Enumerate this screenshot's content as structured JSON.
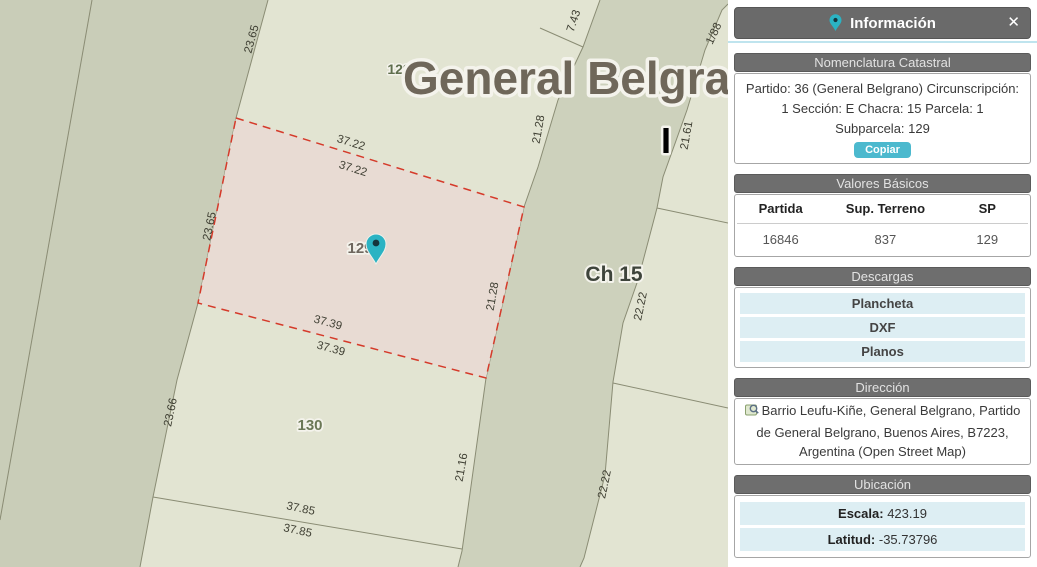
{
  "map": {
    "title": "General Belgrano",
    "labels": {
      "len_2365_a": "23.65",
      "len_2365_b": "23.65",
      "len_3722_a": "37.22",
      "len_3722_b": "37.22",
      "len_3739_a": "37.39",
      "len_3739_b": "37.39",
      "len_2128_a": "21.28",
      "len_2128_b": "21.28",
      "len_743": "7.43",
      "len_188": "1/88",
      "len_2161": "21.61",
      "len_2222_a": "22.22",
      "len_2222_b": "22.22",
      "len_2366": "23.66",
      "len_2116": "21.16",
      "len_3785_a": "37.85",
      "len_3785_b": "37.85",
      "parcel_129": "129",
      "parcel_130": "130",
      "parcel_128": "128",
      "chacra": "Ch 15",
      "roman_i": "I"
    },
    "colors": {
      "parcel_light": "#e2e4d2",
      "parcel_dark": "#c9cdb8",
      "road_strip": "#cdd1bc",
      "highlight_fill": "#e8dbd3",
      "highlight_border": "#d53a2a",
      "pin_teal": "#2bb3c3"
    }
  },
  "panel": {
    "header": {
      "title": "Información",
      "close_icon": "✕"
    },
    "nomenclatura": {
      "section_title": "Nomenclatura Catastral",
      "line1": "Partido: 36 (General Belgrano) Circunscripción:",
      "line2": "1 Sección: E Chacra: 15 Parcela: 1",
      "line3": "Subparcela: 129",
      "copy_button": "Copiar"
    },
    "valores": {
      "section_title": "Valores Básicos",
      "columns": [
        "Partida",
        "Sup. Terreno",
        "SP"
      ],
      "values": [
        "16846",
        "837",
        "129"
      ]
    },
    "descargas": {
      "section_title": "Descargas",
      "items": [
        "Plancheta",
        "DXF",
        "Planos"
      ]
    },
    "direccion": {
      "section_title": "Dirección",
      "text": "Barrio Leufu-Kiñe, General Belgrano, Partido de General Belgrano, Buenos Aires, B7223, Argentina (Open Street Map)"
    },
    "ubicacion": {
      "section_title": "Ubicación",
      "rows": [
        {
          "label": "Escala:",
          "value": "423.19"
        },
        {
          "label": "Latitud:",
          "value": "-35.73796"
        }
      ]
    }
  }
}
